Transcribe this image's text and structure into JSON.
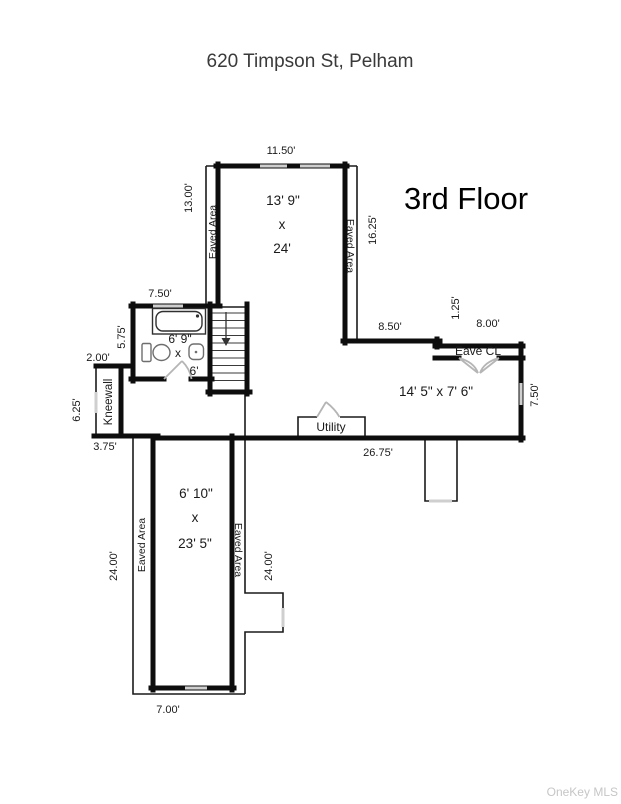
{
  "header": {
    "title": "620 Timpson St, Pelham"
  },
  "plan": {
    "floor_label": "3rd Floor",
    "rooms": {
      "top": {
        "width": "13' 9\"",
        "sep": "x",
        "length": "24'"
      },
      "bath": {
        "width": "6' 9\"",
        "sep": "x",
        "length": "6'"
      },
      "middle": {
        "size": "14' 5\" x 7' 6\""
      },
      "bottom": {
        "width": "6' 10\"",
        "sep": "x",
        "length": "23' 5\""
      }
    },
    "areas": {
      "eaved_top_left": "Eaved Area",
      "eaved_top_right": "Eaved Area",
      "eaved_bottom_left": "Eaved Area",
      "eaved_bottom_right": "Eaved Area",
      "kneewall": "Kneewall",
      "utility": "Utility",
      "eave_closet": "Eave CL"
    },
    "dimensions": {
      "top_width": "11.50'",
      "top_left_height": "13.00'",
      "top_right_height": "16.25'",
      "bath_width": "7.50'",
      "bath_left_height": "5.75'",
      "knee_step": "2.00'",
      "knee_height": "6.25'",
      "knee_bottom": "3.75'",
      "mid_left_width": "8.50'",
      "mid_step": "1.25'",
      "mid_right_width": "8.00'",
      "mid_right_height": "7.50'",
      "mid_bottom_width": "26.75'",
      "bottom_left_height": "24.00'",
      "bottom_right_height": "24.00'",
      "bottom_width": "7.00'"
    }
  },
  "footer": {
    "watermark": "OneKey MLS"
  }
}
